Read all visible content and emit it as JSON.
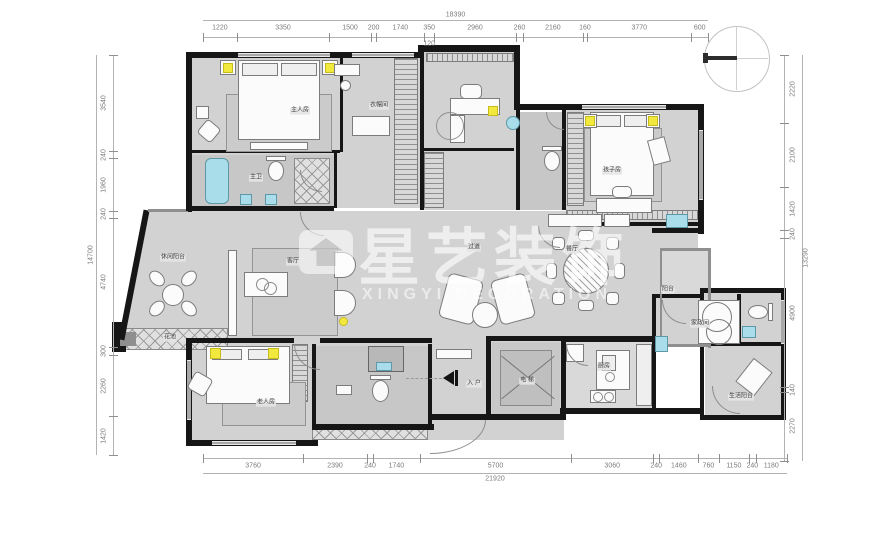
{
  "watermark": {
    "cn": "星艺装饰",
    "en": "XINGYI DECORATION"
  },
  "entry_arrow": {
    "label": "入户"
  },
  "dimensions": {
    "top": {
      "overall": "18390",
      "segments": [
        "1220",
        "3350",
        "1500",
        "200",
        "1740",
        "350",
        "2960",
        "260",
        "2160",
        "160",
        "3770",
        "600"
      ],
      "sub_label": "120",
      "sub_index": 5
    },
    "bottom": {
      "overall": "21920",
      "segments": [
        "3760",
        "2390",
        "240",
        "1740",
        "5700",
        "3060",
        "240",
        "1460",
        "760",
        "1150",
        "240",
        "1180"
      ]
    },
    "left": {
      "overall": "14700",
      "segments": [
        "3540",
        "240",
        "1960",
        "240",
        "4740",
        "300",
        "2260",
        "1420"
      ]
    },
    "right": {
      "overall": "13290",
      "segments": [
        "2220",
        "2100",
        "1420",
        "240",
        "4900",
        "140",
        "2270"
      ]
    }
  },
  "rooms": [
    {
      "id": "master-bedroom",
      "label": "主人房",
      "x": 300,
      "y": 111
    },
    {
      "id": "cloakroom",
      "label": "衣帽间",
      "x": 379,
      "y": 106
    },
    {
      "id": "master-bath",
      "label": "主卫",
      "x": 256,
      "y": 178
    },
    {
      "id": "kids-room",
      "label": "孩子房",
      "x": 612,
      "y": 171
    },
    {
      "id": "leisure-balcony",
      "label": "休闲阳台",
      "x": 173,
      "y": 258
    },
    {
      "id": "living-room",
      "label": "客厅",
      "x": 293,
      "y": 262
    },
    {
      "id": "hallway",
      "label": "过道",
      "x": 474,
      "y": 248
    },
    {
      "id": "dining-room",
      "label": "餐厅",
      "x": 572,
      "y": 250
    },
    {
      "id": "balcony-right",
      "label": "阳台",
      "x": 668,
      "y": 290
    },
    {
      "id": "flower-bed",
      "label": "花池",
      "x": 170,
      "y": 338
    },
    {
      "id": "elderly-room",
      "label": "老人房",
      "x": 266,
      "y": 403
    },
    {
      "id": "entry",
      "label": "入 户",
      "x": 474,
      "y": 384
    },
    {
      "id": "elevator",
      "label": "电 梯",
      "x": 527,
      "y": 381
    },
    {
      "id": "kitchen",
      "label": "厨房",
      "x": 604,
      "y": 367
    },
    {
      "id": "laundry",
      "label": "家政间",
      "x": 700,
      "y": 324
    },
    {
      "id": "service-balcony",
      "label": "生活阳台",
      "x": 741,
      "y": 397
    }
  ],
  "colors": {
    "wall": "#161616",
    "floor": "#d2d2d2",
    "fixture_teal": "#a9dde9",
    "accent_yellow": "#f2e93f",
    "dim_text": "#7c7c7c"
  }
}
